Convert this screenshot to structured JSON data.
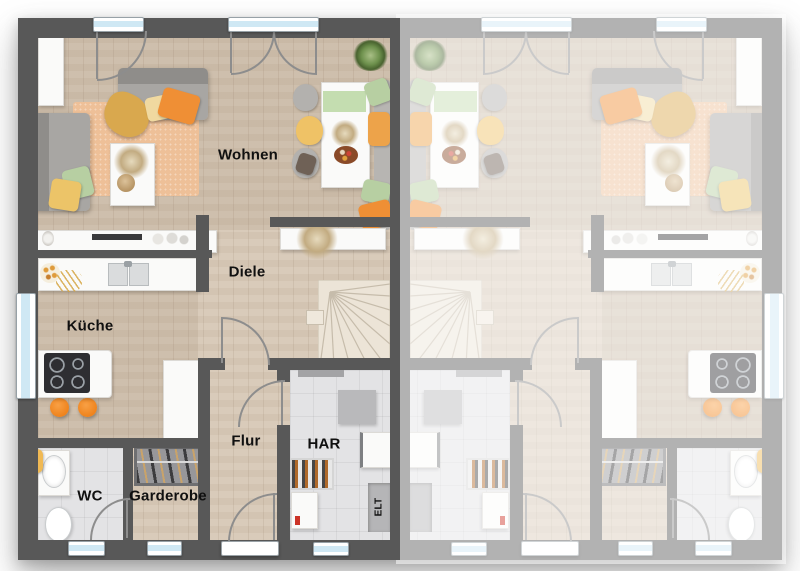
{
  "floorplan": {
    "rooms": {
      "wohnen": "Wohnen",
      "diele": "Diele",
      "kueche": "Küche",
      "flur": "Flur",
      "har": "HAR",
      "wc": "WC",
      "garderobe": "Garderobe",
      "elt": "ELT"
    },
    "units": [
      {
        "id": "unit-left",
        "style": "labeled"
      },
      {
        "id": "unit-right",
        "style": "faded unlabeled mirror"
      }
    ],
    "colors": {
      "wall": "#585858",
      "wall_faded": "#a8a8a8",
      "floor_wood": "#d7c8b6",
      "floor_tile": "#e3e3e5",
      "rug": "#eec098",
      "accent_orange": "#ef8f35",
      "accent_yellow": "#ecc468",
      "accent_green": "#b7cfa2",
      "sofa_gray": "#a5a3a0",
      "window_glass": "#cfe8f4"
    }
  }
}
